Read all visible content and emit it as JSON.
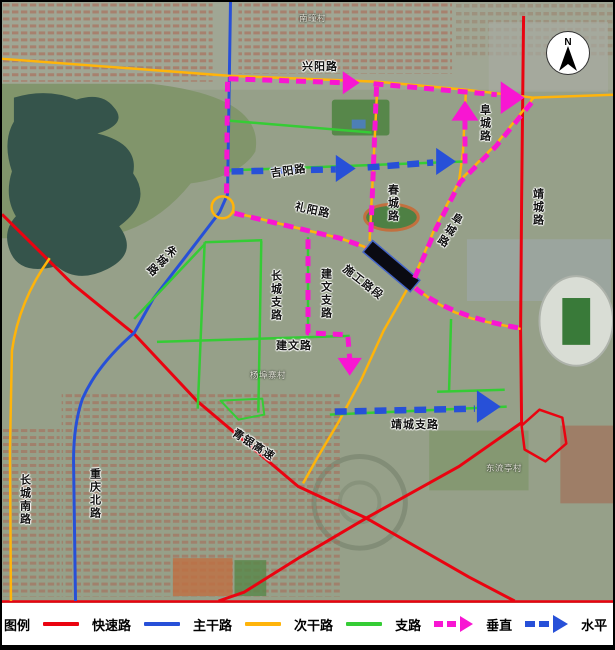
{
  "colors": {
    "expressway": "#ea0310",
    "arterial": "#2750d8",
    "secondary": "#ffb40a",
    "branch": "#35cc35",
    "vertical": "#f816d2",
    "construction_fill": "#0a0a12",
    "construction_stroke": "#4565c8"
  },
  "compass": {
    "label": "N"
  },
  "legend": {
    "title": "图例",
    "items": [
      {
        "label": "快速路",
        "type": "line",
        "color": "expressway"
      },
      {
        "label": "主干路",
        "type": "line",
        "color": "arterial"
      },
      {
        "label": "次干路",
        "type": "line",
        "color": "secondary"
      },
      {
        "label": "支路",
        "type": "line",
        "color": "branch"
      },
      {
        "label": "垂直",
        "type": "dashed-arrow",
        "color": "vertical"
      },
      {
        "label": "水平",
        "type": "dashed-arrow",
        "color": "arterial"
      }
    ]
  },
  "map": {
    "roads": [
      {
        "id": "qingyin-expressway",
        "color": "expressway",
        "w": 3,
        "d": "M 0,213 L 70,282 L 133,333 L 196,400 L 298,486 L 367,518 L 470,577 L 516,601"
      },
      {
        "id": "jingcheng-road-red",
        "color": "expressway",
        "w": 3,
        "d": "M 525,14 L 523,200 L 522,330 L 523,422 L 460,466 L 368,517 L 300,557 L 244,592 L 218,601"
      },
      {
        "id": "bottom-edge-road",
        "color": "expressway",
        "w": 2.5,
        "d": "M 0,601.5 L 615,601.5"
      },
      {
        "id": "ramp-loop",
        "color": "expressway",
        "w": 2.5,
        "d": "M 523,425 L 541,409 L 564,417 L 568,443 L 547,461 L 526,449 Z"
      },
      {
        "id": "zhucheng-chongqing-arterial",
        "color": "arterial",
        "w": 3,
        "d": "M 230,0 L 227,193 L 219,211 L 186,254 L 152,298 L 133,332 Q 96,364 81,398 Q 72,424 72,460 L 74,601"
      },
      {
        "id": "xingyang-road",
        "color": "secondary",
        "w": 2.5,
        "d": "M 0,57 L 228,74 L 378,80 L 467,88 L 535,96 L 615,93"
      },
      {
        "id": "chuncheng-road",
        "color": "secondary",
        "w": 2.5,
        "d": "M 378,80 L 374,160 L 370,240"
      },
      {
        "id": "fucheng-road-vertical",
        "color": "secondary",
        "w": 2.5,
        "d": "M 467,88 L 464,150 L 460,180"
      },
      {
        "id": "fucheng-road-diagonal",
        "color": "secondary",
        "w": 2.5,
        "d": "M 535,96 L 497,143 L 460,180 L 436,226 L 412,283"
      },
      {
        "id": "fucheng-road-east",
        "color": "secondary",
        "w": 2.5,
        "d": "M 412,283 Q 445,312 483,320 L 522,328"
      },
      {
        "id": "south-secondary-road",
        "color": "secondary",
        "w": 2.5,
        "d": "M 408,288 L 384,330 L 362,378 L 339,421 L 317,458 L 303,483"
      },
      {
        "id": "liyang-road",
        "color": "secondary",
        "w": 2.5,
        "d": "M 233,211 L 290,225 L 340,237 L 369,247"
      },
      {
        "id": "changcheng-south-road",
        "color": "secondary",
        "w": 2.5,
        "d": "M 48,257 Q 17,300 10,350 L 8,450 L 9,601"
      },
      {
        "id": "green-top-branch",
        "color": "branch",
        "w": 2.5,
        "d": "M 228,119 L 372,131"
      },
      {
        "id": "jiyang-road-branch",
        "color": "branch",
        "w": 2.5,
        "d": "M 228,169 L 465,160"
      },
      {
        "id": "grid-top-branch",
        "color": "branch",
        "w": 2.5,
        "d": "M 204,241 L 262,239"
      },
      {
        "id": "changcheng-branch-road",
        "color": "branch",
        "w": 2.5,
        "d": "M 261,240 L 258,412"
      },
      {
        "id": "grid-west-branch",
        "color": "branch",
        "w": 2.5,
        "d": "M 204,241 L 200,337 L 197,408"
      },
      {
        "id": "grid-diag-branch",
        "color": "branch",
        "w": 2.5,
        "d": "M 204,243 L 133,318"
      },
      {
        "id": "jianwen-road",
        "color": "branch",
        "w": 2.5,
        "d": "M 156,341 L 350,335"
      },
      {
        "id": "jianwen-branch-road",
        "color": "branch",
        "w": 2.5,
        "d": "M 308,236 L 308,334"
      },
      {
        "id": "jingcheng-branch-road",
        "color": "branch",
        "w": 2.5,
        "d": "M 330,414 L 508,406"
      },
      {
        "id": "east-vert-branch",
        "color": "branch",
        "w": 2.5,
        "d": "M 452,318 L 450,390"
      },
      {
        "id": "east-horiz-branch",
        "color": "branch",
        "w": 2.5,
        "d": "M 438,391 L 506,389"
      },
      {
        "id": "green-polygon",
        "color": "branch",
        "w": 2,
        "d": "M 220,400 L 262,398 L 264,414 L 238,419 Z"
      }
    ],
    "circles": [
      {
        "id": "roundabout",
        "cx": 222,
        "cy": 206,
        "r": 11,
        "color": "secondary",
        "w": 2.5
      }
    ],
    "dashed": [
      {
        "id": "v-xingyang-1",
        "color": "vertical",
        "w": 5,
        "dash": "10 7",
        "d": "M 228,77 L 344,81"
      },
      {
        "id": "v-xingyang-2",
        "color": "vertical",
        "w": 5,
        "dash": "10 7",
        "d": "M 374,82 L 498,93"
      },
      {
        "id": "v-west-leg",
        "color": "vertical",
        "w": 5,
        "dash": "10 7",
        "d": "M 227,80 L 226,193"
      },
      {
        "id": "v-liyang-leg",
        "color": "vertical",
        "w": 5,
        "dash": "10 7",
        "d": "M 234,212 L 340,237 L 366,246"
      },
      {
        "id": "v-chuncheng-leg",
        "color": "vertical",
        "w": 5,
        "dash": "10 7",
        "d": "M 377,85 L 371,238"
      },
      {
        "id": "v-fucheng-diag-leg",
        "color": "vertical",
        "w": 5,
        "dash": "10 7",
        "d": "M 533,101 L 497,145 L 461,181 L 437,227 L 414,280"
      },
      {
        "id": "v-fucheng-up-leg",
        "color": "vertical",
        "w": 5,
        "dash": "10 7",
        "d": "M 466,162 L 466,114"
      },
      {
        "id": "v-east-leg",
        "color": "vertical",
        "w": 5,
        "dash": "10 7",
        "d": "M 416,287 Q 450,315 520,327"
      },
      {
        "id": "v-jianwen-leg",
        "color": "vertical",
        "w": 5,
        "dash": "10 7",
        "d": "M 308,238 L 308,332 L 348,334 L 350,358"
      },
      {
        "id": "h-jiyang-1",
        "color": "arterial",
        "w": 6.5,
        "dash": "12 8",
        "d": "M 231,170 L 336,168"
      },
      {
        "id": "h-jiyang-2",
        "color": "arterial",
        "w": 6.5,
        "dash": "12 8",
        "d": "M 368,166 L 434,161"
      },
      {
        "id": "h-jingcheng-branch",
        "color": "arterial",
        "w": 6.5,
        "dash": "12 8",
        "d": "M 335,411 L 476,408"
      }
    ],
    "arrows": [
      {
        "id": "v-arrow-xingyang-mid",
        "color": "vertical",
        "x": 360,
        "y": 81,
        "dir": "E",
        "s": 17
      },
      {
        "id": "v-arrow-xingyang-end",
        "color": "vertical",
        "x": 526,
        "y": 96,
        "dir": "E",
        "s": 24
      },
      {
        "id": "v-arrow-fucheng-up",
        "color": "vertical",
        "x": 466,
        "y": 99,
        "dir": "N",
        "s": 20
      },
      {
        "id": "v-arrow-jianwen-down",
        "color": "vertical",
        "x": 350,
        "y": 375,
        "dir": "S",
        "s": 18
      },
      {
        "id": "h-arrow-jiyang-mid",
        "color": "arterial",
        "x": 356,
        "y": 167,
        "dir": "E",
        "s": 20
      },
      {
        "id": "h-arrow-jiyang-end",
        "color": "arterial",
        "x": 457,
        "y": 160,
        "dir": "E",
        "s": 20
      },
      {
        "id": "h-arrow-jingcheng-branch",
        "color": "arterial",
        "x": 502,
        "y": 406,
        "dir": "E",
        "s": 24
      }
    ],
    "construction": {
      "label": "施工路段",
      "cx": 392,
      "cy": 265,
      "len": 62,
      "wid": 15,
      "rot": 40
    },
    "labels": [
      {
        "id": "xingyang-road-label",
        "text": "兴阳路",
        "x": 300,
        "y": 60,
        "rot": 0,
        "vertical": false,
        "style": "road"
      },
      {
        "id": "jiyang-road-label",
        "text": "吉阳路",
        "x": 268,
        "y": 167,
        "rot": -8,
        "vertical": false,
        "style": "road"
      },
      {
        "id": "liyang-road-label",
        "text": "礼阳路",
        "x": 294,
        "y": 200,
        "rot": 12,
        "vertical": false,
        "style": "road"
      },
      {
        "id": "chuncheng-road-label",
        "text": "春城路",
        "x": 384,
        "y": 182,
        "rot": 0,
        "vertical": true,
        "style": "road"
      },
      {
        "id": "fucheng-road-label-north",
        "text": "阜城路",
        "x": 476,
        "y": 102,
        "rot": 0,
        "vertical": true,
        "style": "road"
      },
      {
        "id": "fucheng-road-label-south",
        "text": "阜城路",
        "x": 452,
        "y": 208,
        "rot": 32,
        "vertical": true,
        "style": "road"
      },
      {
        "id": "jingcheng-road-label",
        "text": "靖城路",
        "x": 529,
        "y": 186,
        "rot": 0,
        "vertical": true,
        "style": "road"
      },
      {
        "id": "construction-label",
        "text": "施工路段",
        "x": 345,
        "y": 262,
        "rot": 38,
        "vertical": false,
        "style": "road"
      },
      {
        "id": "changcheng-branch-label",
        "text": "长城支路",
        "x": 267,
        "y": 268,
        "rot": 0,
        "vertical": true,
        "style": "road"
      },
      {
        "id": "jianwen-branch-label",
        "text": "建文支路",
        "x": 317,
        "y": 266,
        "rot": 0,
        "vertical": true,
        "style": "road"
      },
      {
        "id": "jianwen-road-label",
        "text": "建文路",
        "x": 274,
        "y": 339,
        "rot": 0,
        "vertical": false,
        "style": "road"
      },
      {
        "id": "jingcheng-branch-label",
        "text": "靖城支路",
        "x": 389,
        "y": 418,
        "rot": 0,
        "vertical": false,
        "style": "road"
      },
      {
        "id": "zhucheng-road-label",
        "text": "朱城路",
        "x": 168,
        "y": 240,
        "rot": 45,
        "vertical": true,
        "style": "road"
      },
      {
        "id": "qingyin-expressway-label",
        "text": "青银高速",
        "x": 234,
        "y": 426,
        "rot": 33,
        "vertical": false,
        "style": "road"
      },
      {
        "id": "changcheng-south-label",
        "text": "长城南路",
        "x": 16,
        "y": 472,
        "rot": 0,
        "vertical": true,
        "style": "road"
      },
      {
        "id": "chongqing-north-label",
        "text": "重庆北路",
        "x": 86,
        "y": 466,
        "rot": 0,
        "vertical": true,
        "style": "road"
      },
      {
        "id": "nantuan-village-label",
        "text": "南疃村",
        "x": 297,
        "y": 12,
        "rot": 0,
        "vertical": false,
        "style": "village"
      },
      {
        "id": "yangbuzhai-village-label",
        "text": "杨埠寨村",
        "x": 248,
        "y": 369,
        "rot": 0,
        "vertical": false,
        "style": "village"
      },
      {
        "id": "dongliuting-village-label",
        "text": "东流亭村",
        "x": 484,
        "y": 462,
        "rot": 0,
        "vertical": false,
        "style": "village"
      }
    ]
  }
}
